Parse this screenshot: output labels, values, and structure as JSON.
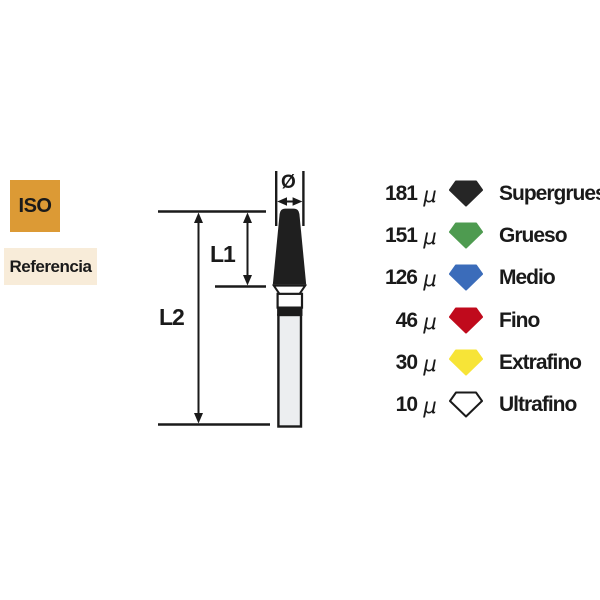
{
  "badges": {
    "iso": {
      "label": "ISO",
      "bg": "#DC9A35",
      "text_color": "#1A1A1A"
    },
    "referencia": {
      "label": "Referencia",
      "bg": "#F8ECD9",
      "text_color": "#1A1A1A"
    }
  },
  "diagram": {
    "diameter_symbol": "Ø",
    "length_labels": {
      "l1": "L1",
      "l2": "L2"
    },
    "colors": {
      "line": "#1A1A1A",
      "tip": "#1F1F1F",
      "neck": "#FFFFFF",
      "collar": "#FCFCFC",
      "band": "#1A1A1A",
      "shank": "#ECEEF0"
    }
  },
  "legend": {
    "unit_symbol": "μ",
    "items": [
      {
        "value": "181",
        "label": "Supergrueso",
        "fill": "#262626",
        "stroke": "#262626"
      },
      {
        "value": "151",
        "label": "Grueso",
        "fill": "#4E9B50",
        "stroke": "#4E9B50"
      },
      {
        "value": "126",
        "label": "Medio",
        "fill": "#3B6CBA",
        "stroke": "#3B6CBA"
      },
      {
        "value": "46",
        "label": "Fino",
        "fill": "#C00A1C",
        "stroke": "#C00A1C"
      },
      {
        "value": "30",
        "label": "Extrafino",
        "fill": "#F7E437",
        "stroke": "#F7E437"
      },
      {
        "value": "10",
        "label": "Ultrafino",
        "fill": "#FFFFFF",
        "stroke": "#1A1A1A"
      }
    ]
  }
}
